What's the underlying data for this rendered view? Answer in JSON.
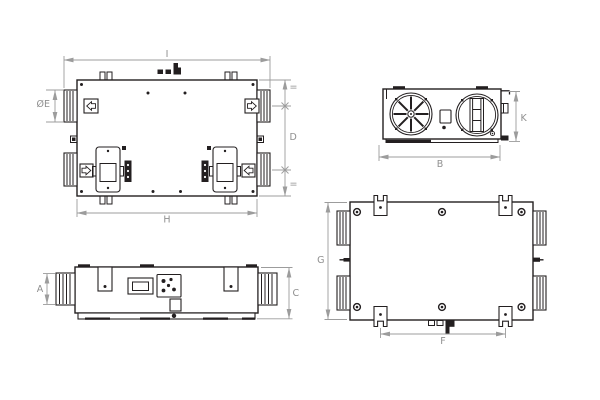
{
  "colors": {
    "background": "#ffffff",
    "drawing_line": "#231f20",
    "dimension": "#9c9c9c",
    "dimension_text": "#8f8f8f"
  },
  "views": {
    "top": {
      "dims": {
        "total_length": "I",
        "body_length": "H",
        "spigot_diameter": "ØE",
        "port_spacing": "D",
        "equal_top": "=",
        "equal_bottom": "="
      }
    },
    "end": {
      "dims": {
        "width": "B",
        "height": "K"
      }
    },
    "front": {
      "dims": {
        "spigot_height": "A",
        "total_height": "C"
      }
    },
    "bottom": {
      "dims": {
        "depth": "G",
        "bracket_spacing": "F"
      }
    }
  }
}
